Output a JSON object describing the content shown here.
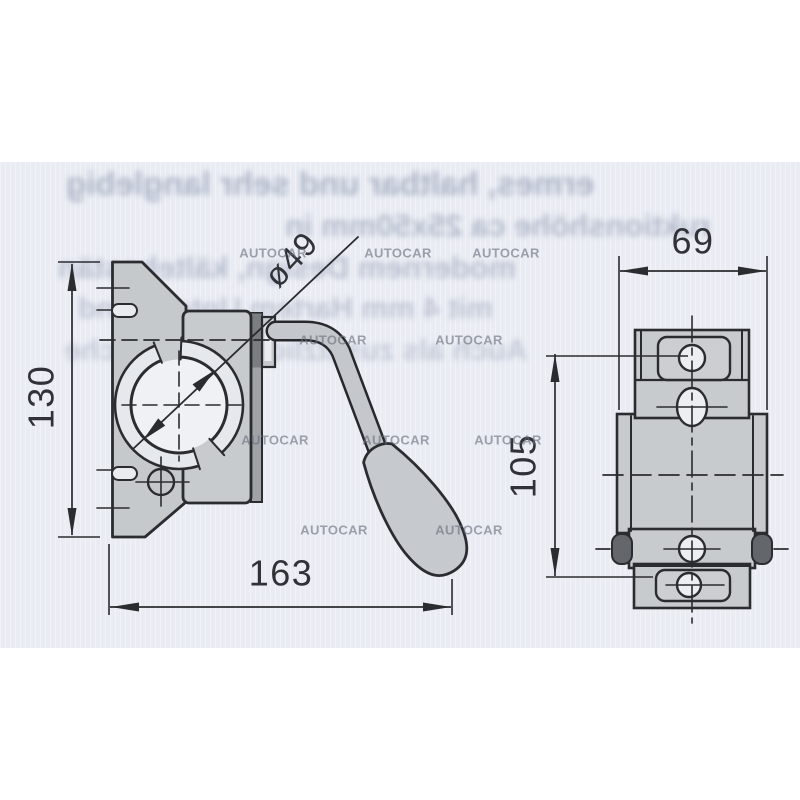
{
  "watermark": {
    "text": "AUTOCAR"
  },
  "labels": {
    "d130": "130",
    "d163": "163",
    "d49": "ø49",
    "d69": "69",
    "d105": "105"
  },
  "bleed_lines": [
    "ermes, haltbar und sehr langlebig",
    "ruktionshöhe ca 25x50mm in",
    "modernem Design, kältebestän",
    "mit 4 mm Hartem Untergrund",
    "Auch als zusätzliche bewegliche"
  ],
  "colors": {
    "paper": "#ffffff",
    "scan_band": "#e9ecf3",
    "ink": "#2a2c30",
    "metal": "#c8cbce",
    "metal_dark": "#7a7e83",
    "hole_fill": "#eff1f5",
    "watermark": "#696e7a",
    "bleed_text": "#7d87a3"
  }
}
